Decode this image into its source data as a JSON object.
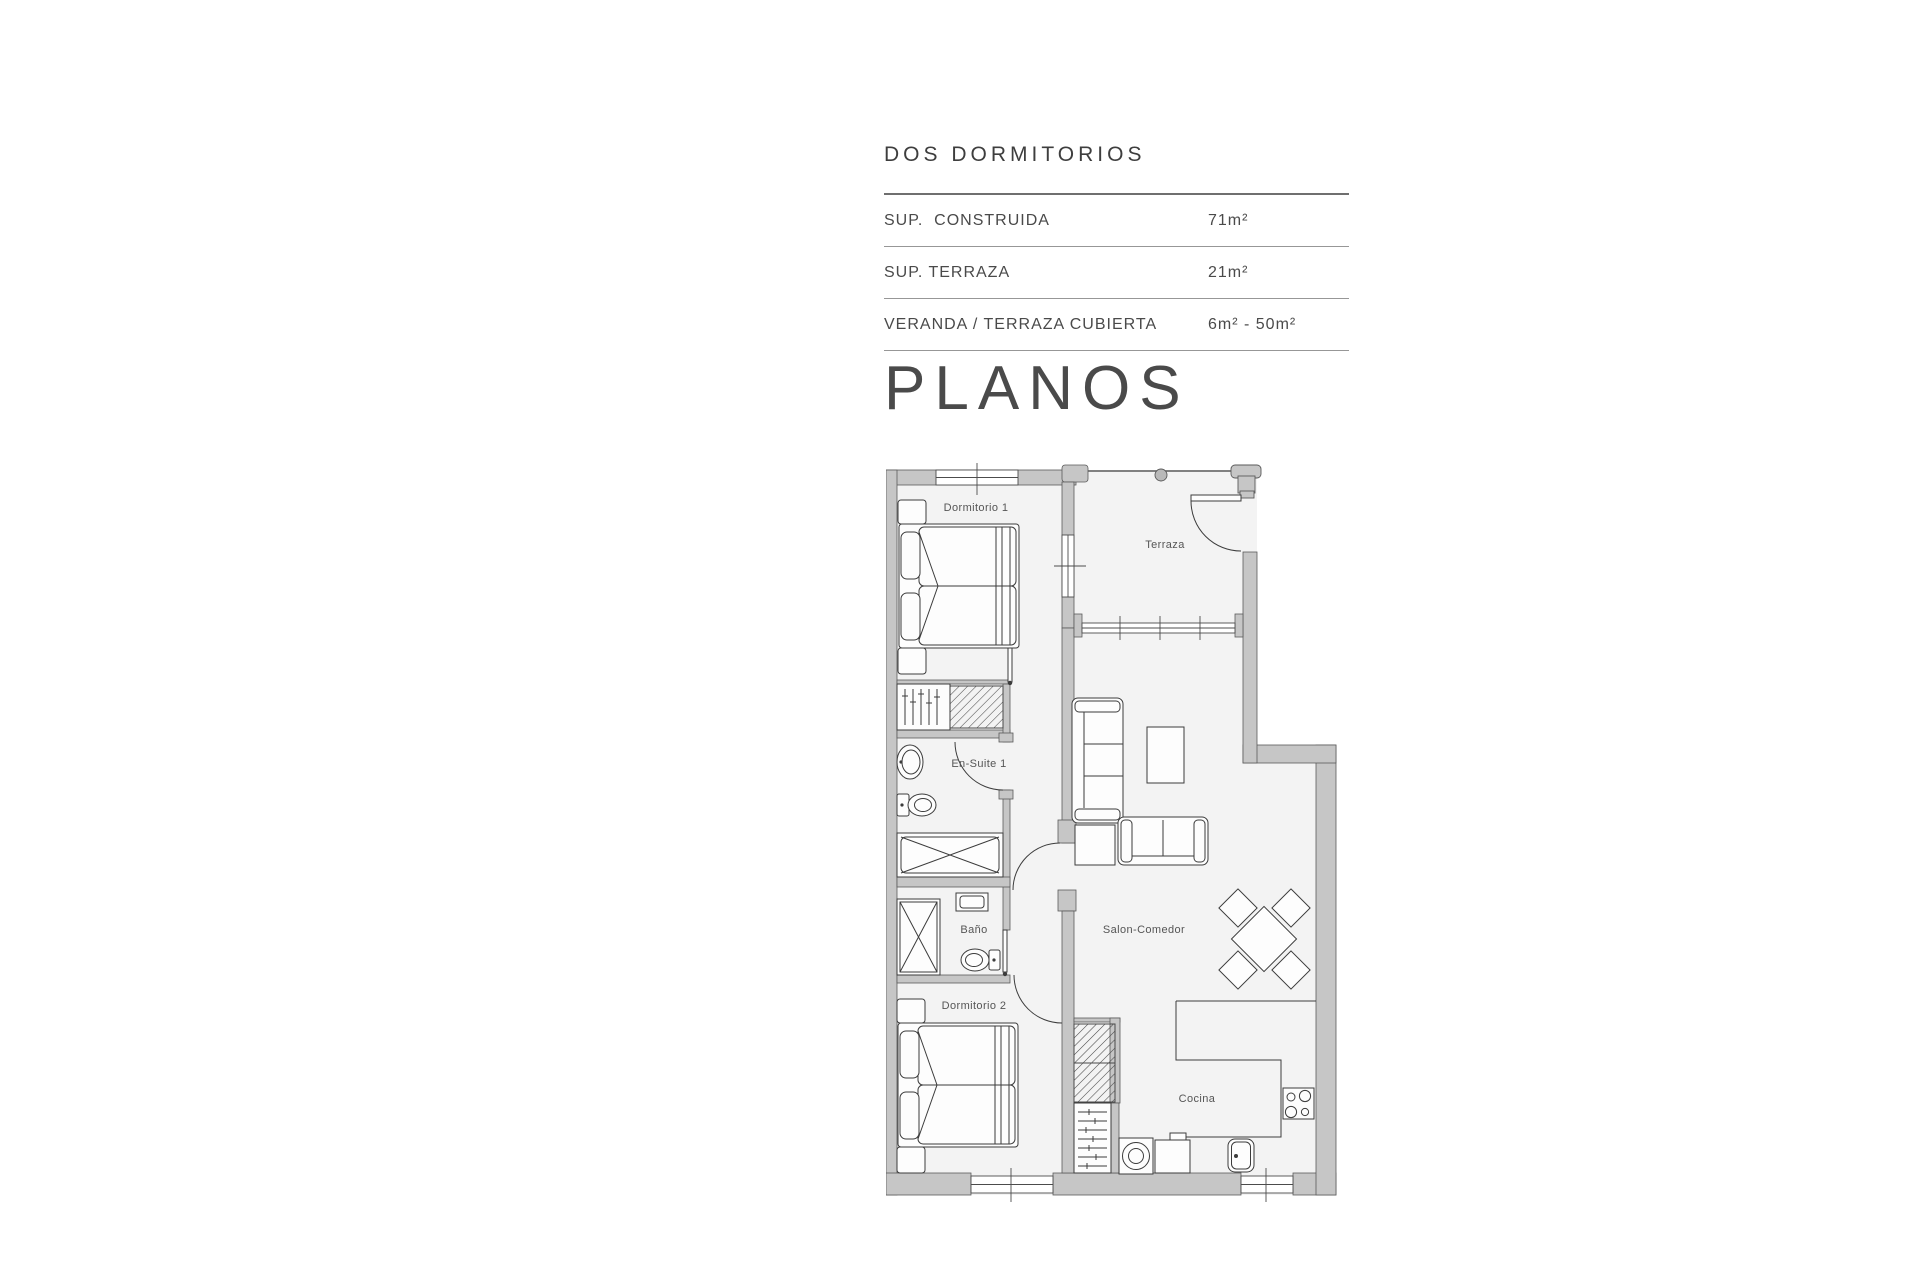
{
  "spec_panel": {
    "title": "DOS DORMITORIOS",
    "rows": [
      {
        "label": "SUP.  CONSTRUIDA",
        "value": "71m²"
      },
      {
        "label": "SUP. TERRAZA",
        "value": "21m²"
      },
      {
        "label": "VERANDA / TERRAZA CUBIERTA",
        "value": "6m² - 50m²"
      }
    ],
    "heading": "PLANOS"
  },
  "floor_plan": {
    "rooms": [
      {
        "id": "dormitorio-1",
        "label": "Dormitorio 1"
      },
      {
        "id": "terraza",
        "label": "Terraza"
      },
      {
        "id": "en-suite-1",
        "label": "En-Suite 1"
      },
      {
        "id": "bano",
        "label": "Baño"
      },
      {
        "id": "salon-comedor",
        "label": "Salon-Comedor"
      },
      {
        "id": "dormitorio-2",
        "label": "Dormitorio 2"
      },
      {
        "id": "cocina",
        "label": "Cocina"
      }
    ],
    "colors": {
      "wall": "#c6c6c6",
      "wall_stroke": "#5a5a5a",
      "floor": "#f3f3f3",
      "line": "#3c3c3c",
      "hatch": "#4a4a4a"
    }
  }
}
